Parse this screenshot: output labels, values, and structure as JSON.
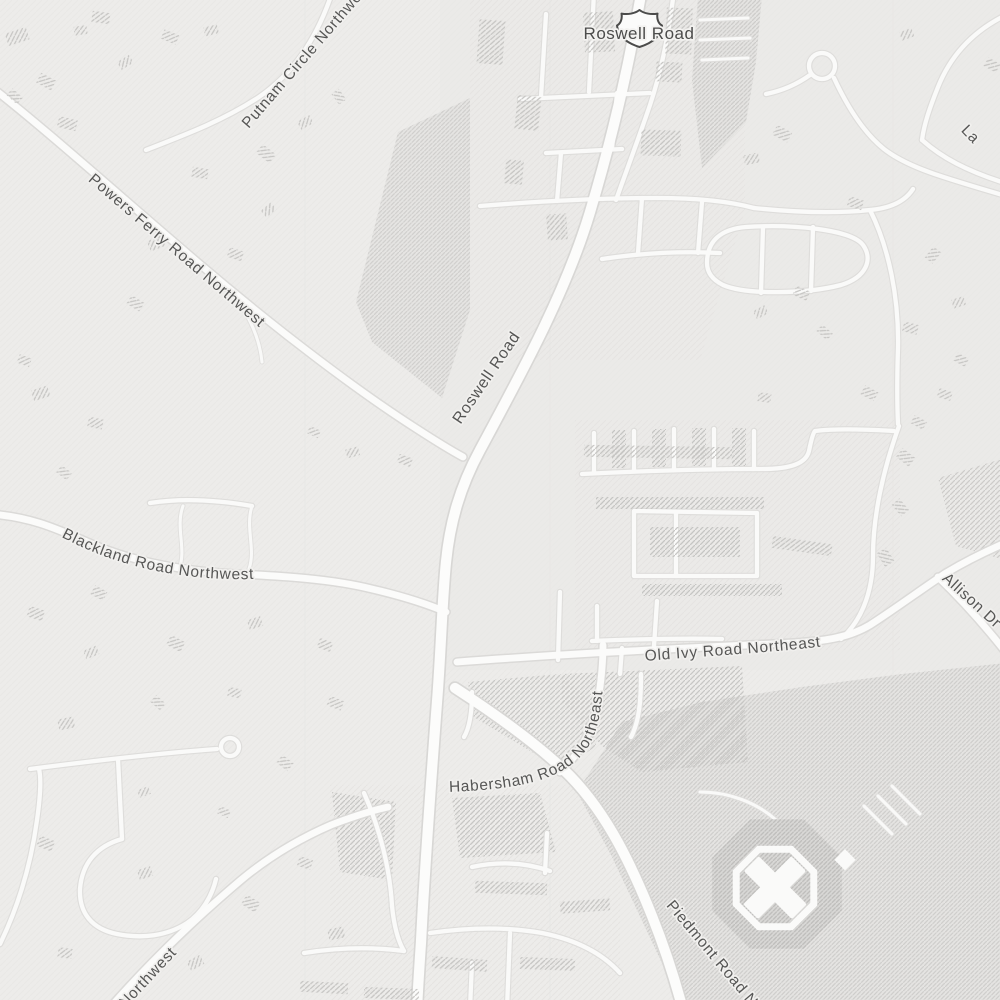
{
  "map": {
    "view": "street-map-light-gray",
    "labels": {
      "shield_road": "Roswell Road",
      "roswell_main": "Roswell Road",
      "powers_ferry": "Powers Ferry Road Northwest",
      "putnam_circle": "Putnam Circle Northwest",
      "blackland": "Blackland Road Northwest",
      "old_ivy": "Old Ivy Road Northeast",
      "habersham": "Habersham Road Northeast",
      "piedmont": "Piedmont Road Northeast",
      "allison": "Allison Dr",
      "northwest_partial": "Northwest",
      "la_partial": "La"
    },
    "icons": {
      "route_shield": "us-route-shield",
      "landmark": "octagon-x-building",
      "culdesac": "cul-de-sac-loop"
    },
    "colors": {
      "background": "#edecea",
      "road_fill": "#fbfbfa",
      "road_casing": "#dadad8",
      "building_hatch": "#c6c5c3",
      "dense_hatch": "#bebdbb",
      "label_text": "#565655",
      "shield_outline": "#4b4b4a"
    }
  }
}
